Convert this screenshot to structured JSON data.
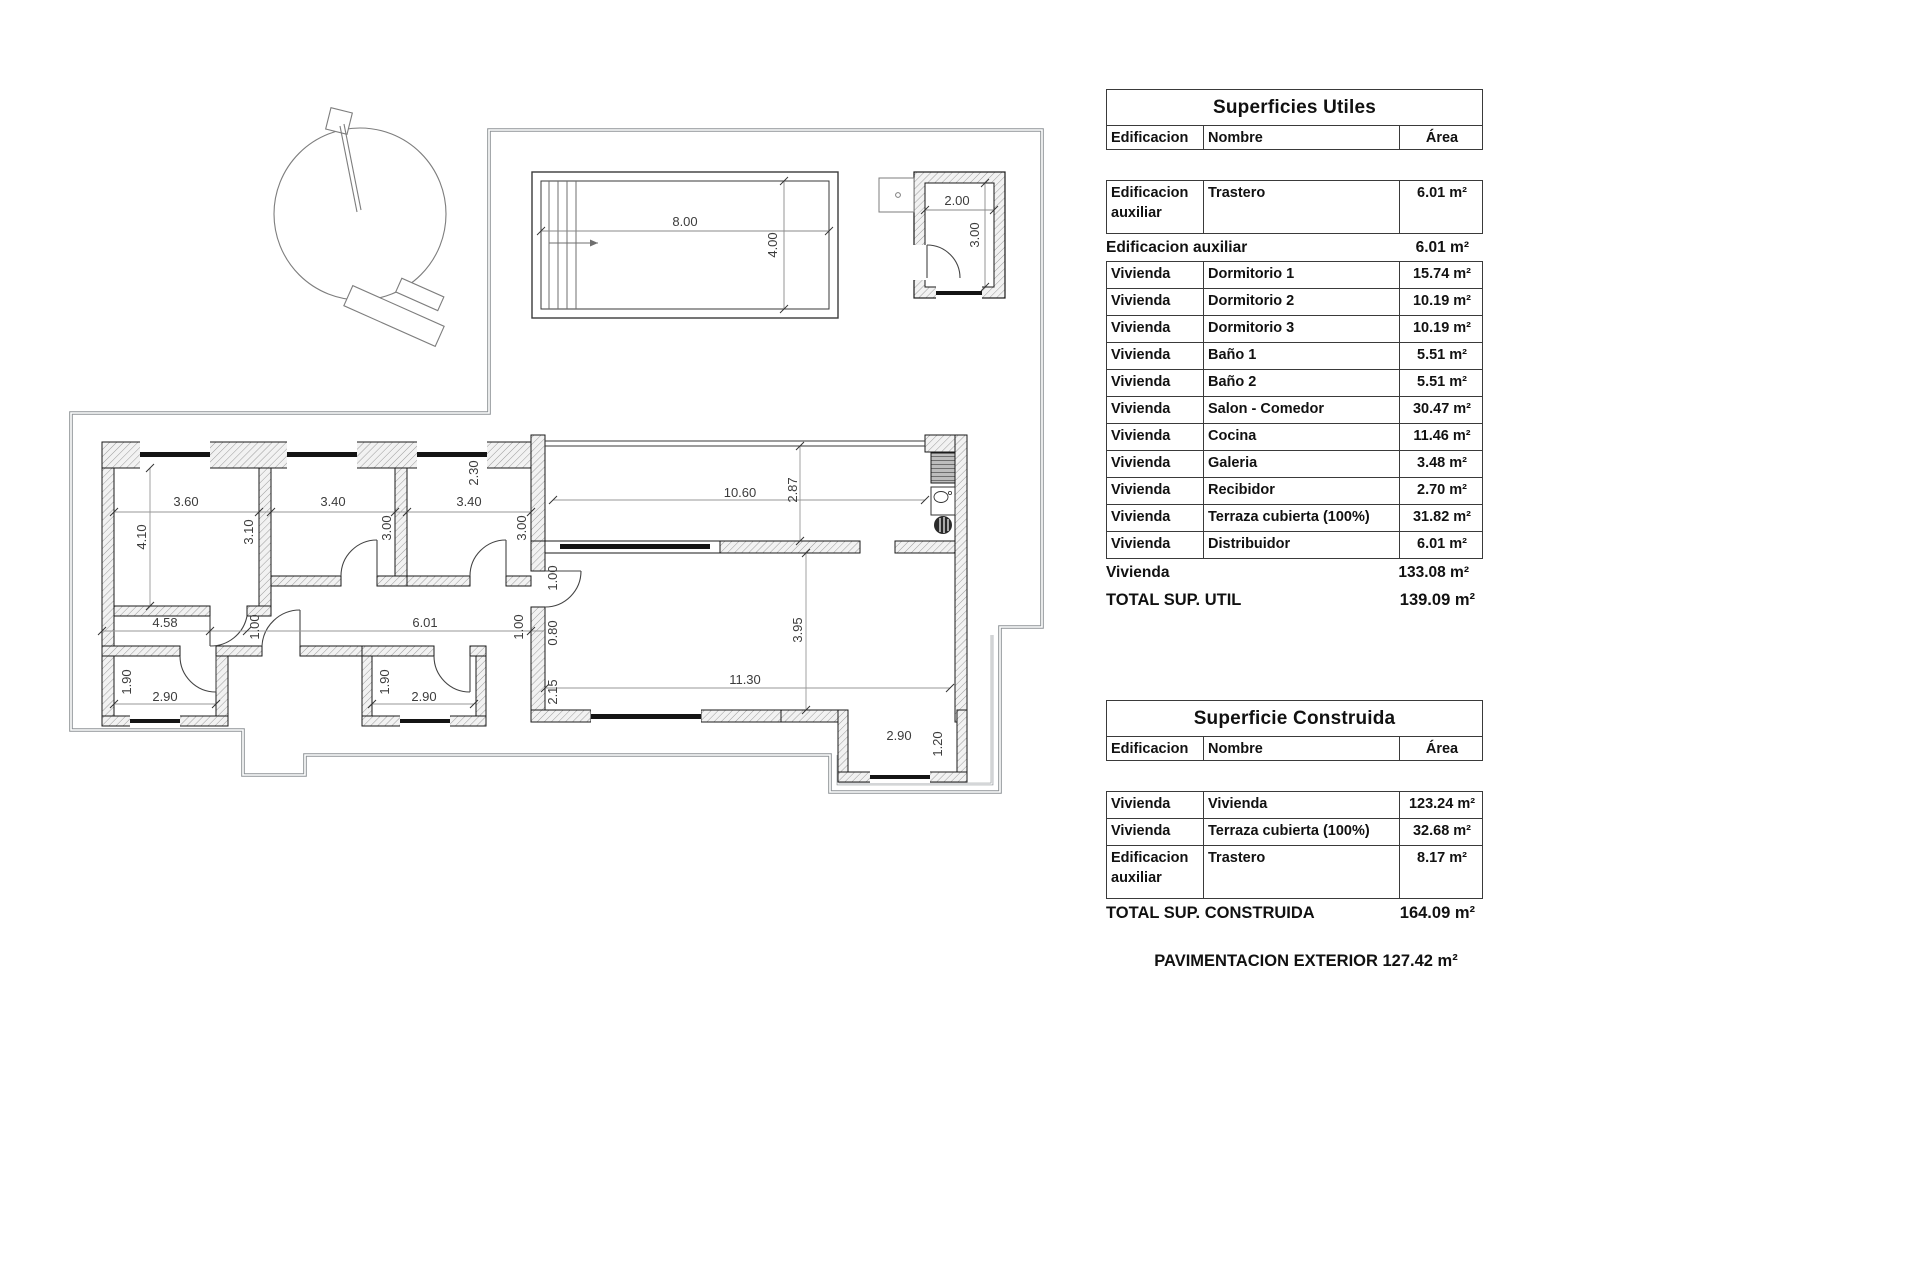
{
  "tables": {
    "utiles": {
      "title": "Superficies Utiles",
      "columns": [
        "Edificacion",
        "Nombre",
        "Área"
      ],
      "rows_aux": [
        [
          "Edificacion auxiliar",
          "Trastero",
          "6.01 m²"
        ]
      ],
      "subtotal_aux": {
        "label": "Edificacion auxiliar",
        "value": "6.01 m²"
      },
      "rows_viv": [
        [
          "Vivienda",
          "Dormitorio 1",
          "15.74 m²"
        ],
        [
          "Vivienda",
          "Dormitorio 2",
          "10.19 m²"
        ],
        [
          "Vivienda",
          "Dormitorio 3",
          "10.19 m²"
        ],
        [
          "Vivienda",
          "Baño 1",
          "5.51 m²"
        ],
        [
          "Vivienda",
          "Baño 2",
          "5.51 m²"
        ],
        [
          "Vivienda",
          "Salon - Comedor",
          "30.47 m²"
        ],
        [
          "Vivienda",
          "Cocina",
          "11.46 m²"
        ],
        [
          "Vivienda",
          "Galeria",
          "3.48 m²"
        ],
        [
          "Vivienda",
          "Recibidor",
          "2.70 m²"
        ],
        [
          "Vivienda",
          "Terraza cubierta (100%)",
          "31.82 m²"
        ],
        [
          "Vivienda",
          "Distribuidor",
          "6.01 m²"
        ]
      ],
      "subtotal_viv": {
        "label": "Vivienda",
        "value": "133.08 m²"
      },
      "total": {
        "label": "TOTAL SUP. UTIL",
        "value": "139.09 m²"
      }
    },
    "construida": {
      "title": "Superficie Construida",
      "columns": [
        "Edificacion",
        "Nombre",
        "Área"
      ],
      "rows": [
        [
          "Vivienda",
          "Vivienda",
          "123.24 m²"
        ],
        [
          "Vivienda",
          "Terraza cubierta (100%)",
          "32.68 m²"
        ],
        [
          "Edificacion auxiliar",
          "Trastero",
          "8.17 m²"
        ]
      ],
      "total": {
        "label": "TOTAL SUP. CONSTRUIDA",
        "value": "164.09 m²"
      }
    },
    "footer": "PAVIMENTACION EXTERIOR 127.42 m²"
  },
  "plan": {
    "dims": {
      "pool_w": "8.00",
      "pool_h": "4.00",
      "trastero_w": "2.00",
      "trastero_h": "3.00",
      "dorm1_w": "3.60",
      "dorm1_h": "4.10",
      "pass1": "3.10",
      "dorm2_w": "3.40",
      "dorm2_h": "3.00",
      "dorm3_w": "3.40",
      "dorm3_h": "3.00",
      "hall_a": "4.58",
      "hall_a_w": "1.00",
      "hall_b": "6.01",
      "hall_b_w": "1.00",
      "reci_w": "1.00",
      "reci_d": "0.80",
      "reci_e": "2.15",
      "terr_gap": "2.30",
      "terr_w": "10.60",
      "terr_h": "2.87",
      "salon_w": "11.30",
      "salon_h": "3.95",
      "bath1_h": "1.90",
      "bath1_w": "2.90",
      "bath2_h": "1.90",
      "bath2_w": "2.90",
      "gal_w": "2.90",
      "gal_h": "1.20"
    }
  }
}
